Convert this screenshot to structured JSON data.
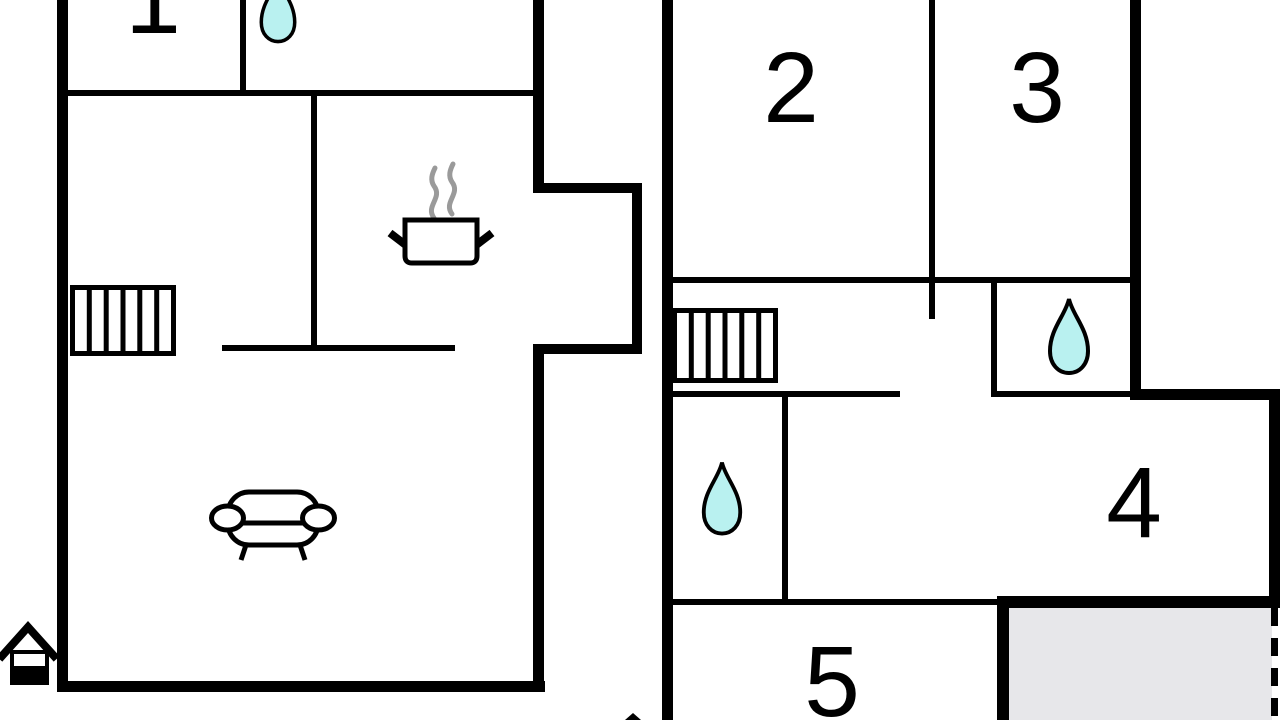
{
  "floorplan": {
    "type": "holiday-home-floor-plan",
    "floors": [
      {
        "name": "ground-floor-left-building",
        "rooms": [
          "room-1-partial",
          "bathroom-top",
          "kitchen-with-stove",
          "stairs-room",
          "living-room-with-sofa"
        ]
      },
      {
        "name": "upper-floor-right-building",
        "rooms": [
          "room-2",
          "room-3",
          "hall-with-stairs",
          "bathroom-top-right",
          "bathroom-middle",
          "room-4",
          "room-5",
          "terrace-gray"
        ]
      }
    ],
    "room_labels": [
      "1",
      "2",
      "3",
      "4",
      "5"
    ],
    "icons": [
      "water-drop-icon",
      "stairs-icon",
      "stove-pot-icon",
      "steam-icon",
      "sofa-icon",
      "house-entrance-icon"
    ],
    "colors": {
      "wall": "#000000",
      "background": "#ffffff",
      "water_drop_fill": "#b9f1f0",
      "terrace_fill": "#e7e7ea",
      "steam": "#9a9a9a"
    }
  }
}
